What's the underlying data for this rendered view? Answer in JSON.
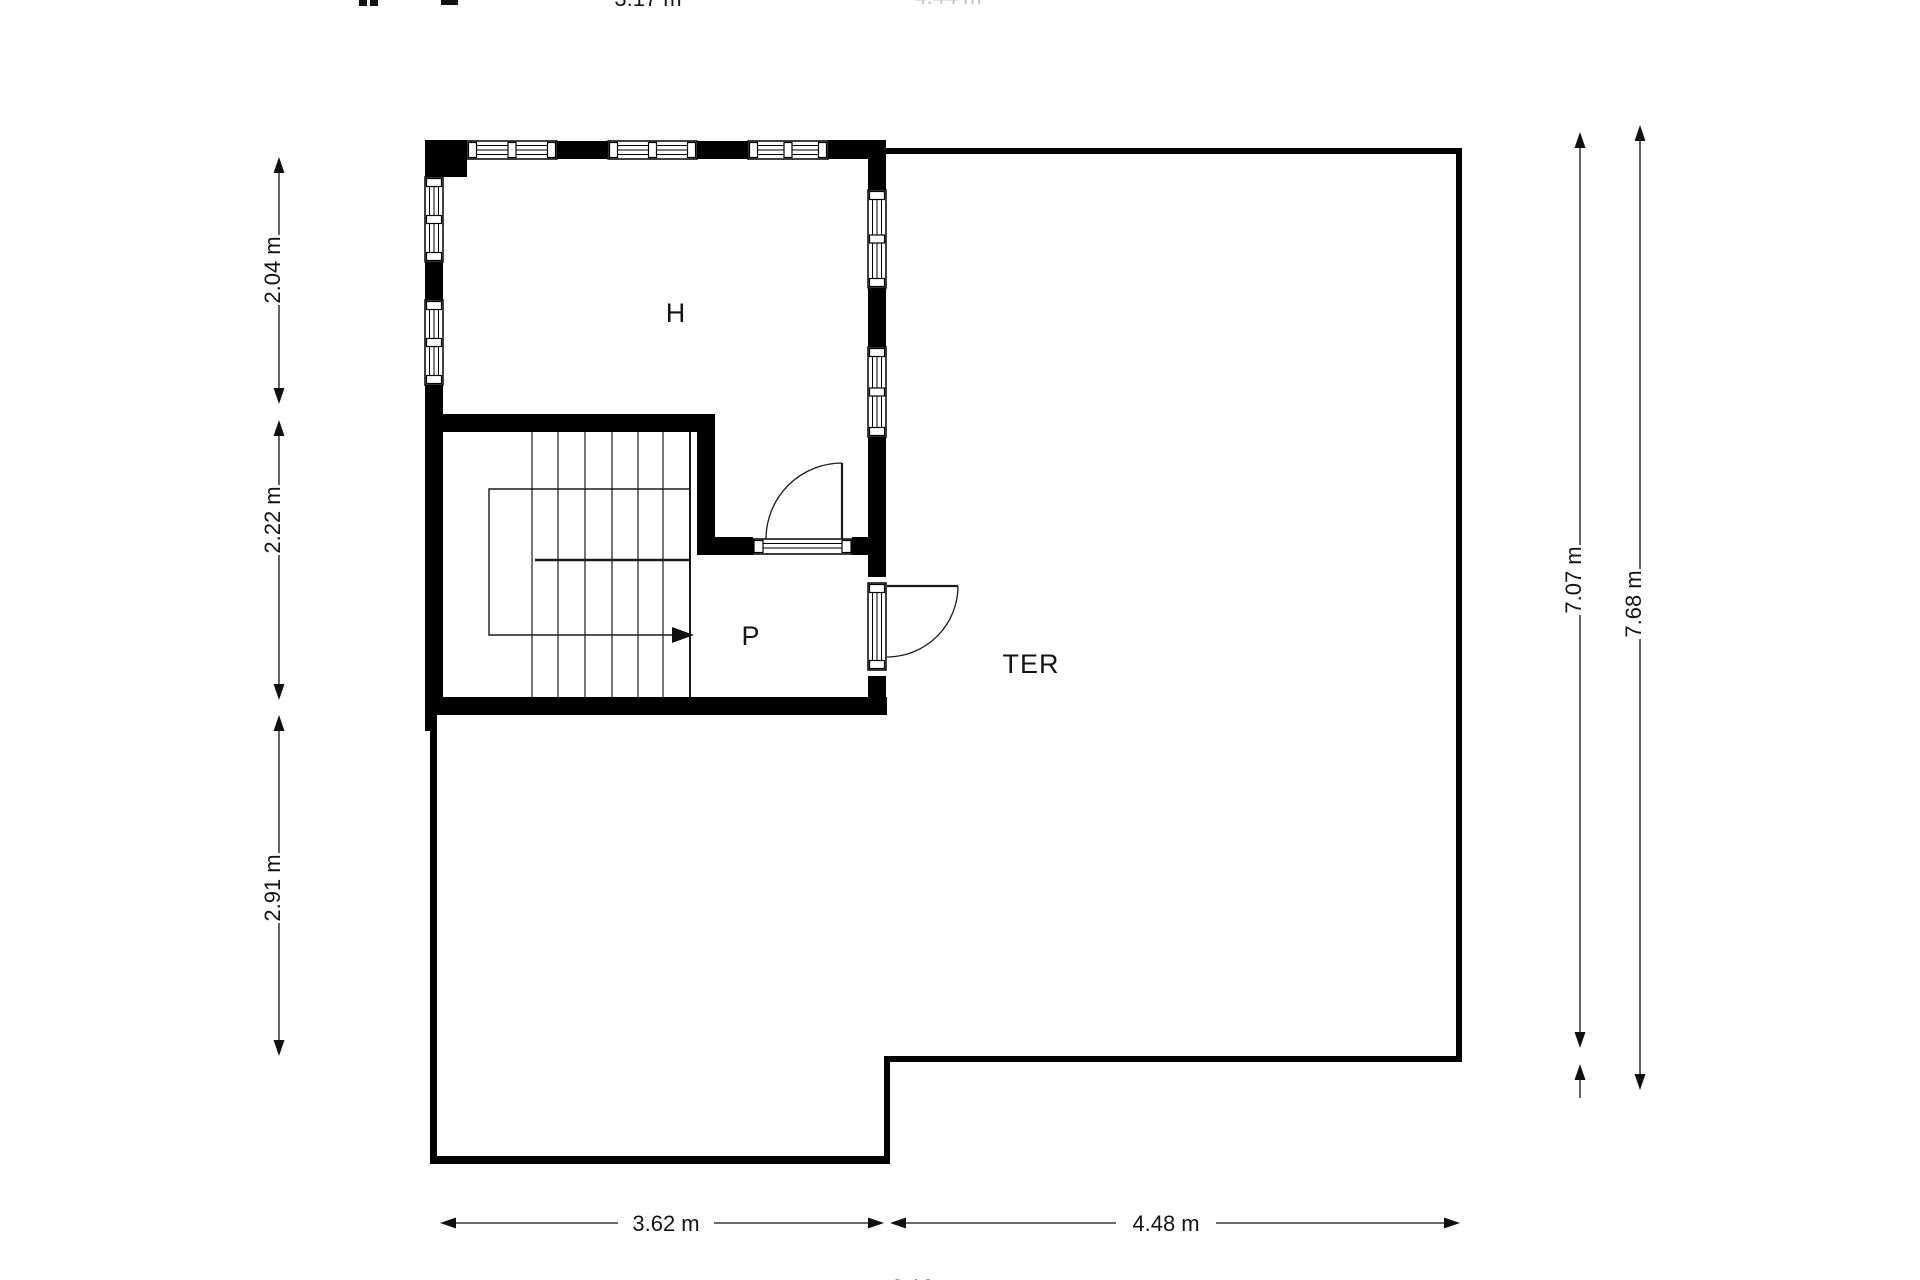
{
  "plan": {
    "background": "#ffffff",
    "wall_color": "#000000",
    "faint_text_color": "#c4c4c4",
    "unit": "m",
    "rooms": [
      {
        "id": "H",
        "label": "H"
      },
      {
        "id": "P",
        "label": "P"
      },
      {
        "id": "TER",
        "label": "TER"
      }
    ],
    "dimensions": {
      "left": [
        {
          "label": "2.04 m"
        },
        {
          "label": "2.22 m"
        },
        {
          "label": "2.91 m"
        }
      ],
      "right": [
        {
          "label": "7.07 m"
        },
        {
          "label": "7.68 m"
        }
      ],
      "bottom": [
        {
          "label": "3.62 m"
        },
        {
          "label": "4.48 m"
        }
      ],
      "bottom_total": {
        "label": "8.10 m"
      },
      "top_partial": [
        {
          "label": "3.17 m"
        },
        {
          "label": "4.44 m"
        }
      ]
    }
  }
}
